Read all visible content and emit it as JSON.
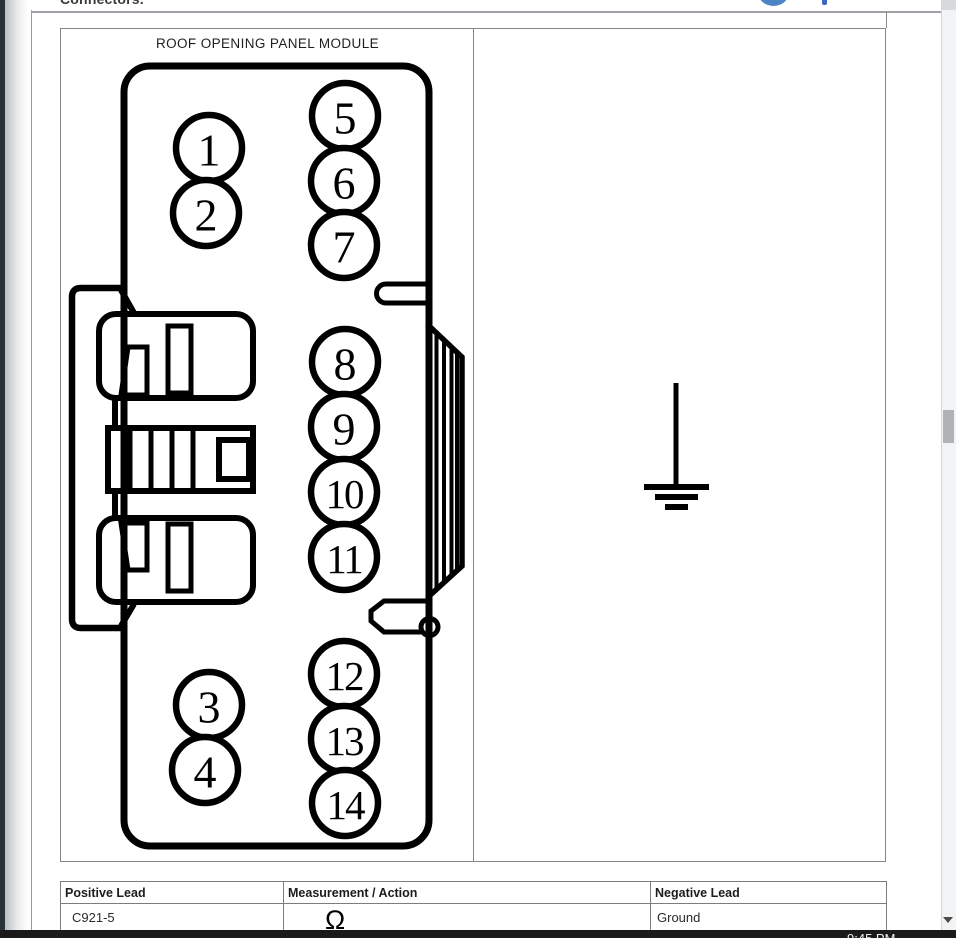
{
  "page": {
    "top_partial_text": "Connectors.",
    "taskbar_time": "9:45 PM"
  },
  "diagram": {
    "title": "ROOF OPENING PANEL MODULE",
    "connector": {
      "pin_radius": 33,
      "pins": [
        {
          "label": "1",
          "x": 209,
          "y": 148
        },
        {
          "label": "2",
          "x": 206,
          "y": 213
        },
        {
          "label": "3",
          "x": 209,
          "y": 705
        },
        {
          "label": "4",
          "x": 205,
          "y": 770
        },
        {
          "label": "5",
          "x": 345,
          "y": 116
        },
        {
          "label": "6",
          "x": 344,
          "y": 181
        },
        {
          "label": "7",
          "x": 344,
          "y": 245
        },
        {
          "label": "8",
          "x": 345,
          "y": 362
        },
        {
          "label": "9",
          "x": 344,
          "y": 427
        },
        {
          "label": "10",
          "x": 344,
          "y": 492
        },
        {
          "label": "11",
          "x": 344,
          "y": 557
        },
        {
          "label": "12",
          "x": 344,
          "y": 674
        },
        {
          "label": "13",
          "x": 344,
          "y": 739
        },
        {
          "label": "14",
          "x": 345,
          "y": 803
        }
      ]
    },
    "icons": {
      "ground_symbol": "earth-ground"
    }
  },
  "table": {
    "columns": [
      "Positive Lead",
      "Measurement / Action",
      "Negative Lead"
    ],
    "rows": [
      [
        "C921-5",
        "Ω",
        "Ground"
      ]
    ]
  },
  "colors": {
    "line_black": "#000000",
    "panel_border_gray": "#858585",
    "accent_blue": "#4d82c5",
    "taskbar_black": "#1a1a1a",
    "scroll_thumb_gray": "#b0b3b5"
  }
}
